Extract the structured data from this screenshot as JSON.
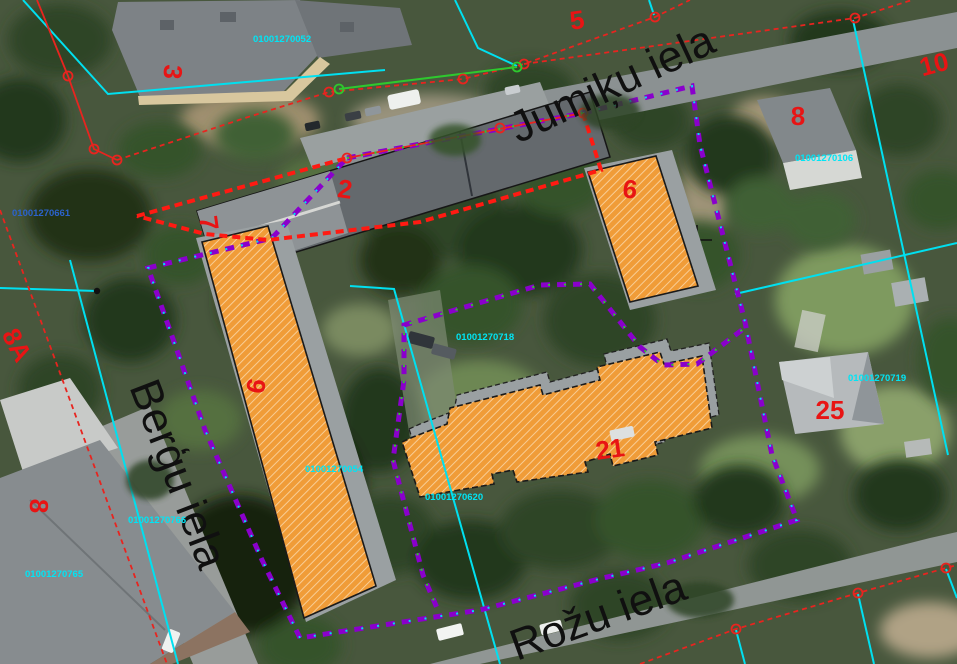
{
  "map": {
    "streets": {
      "jumiku": "Jumiķu iela",
      "bergu": "Berģu iela",
      "rozu": "Rožu iela"
    },
    "parcel_numbers": {
      "p3": "3",
      "p5": "5",
      "p10": "10",
      "p8_ne": "8",
      "p2": "2",
      "p7": "7",
      "p6": "6",
      "p8a": "8A",
      "p9": "9",
      "p8_w": "8",
      "p25": "25",
      "p21": "21"
    },
    "cadastral_codes": {
      "c052": "01001270052",
      "c106": "01001270106",
      "c661": "01001270661",
      "c718": "01001270718",
      "c719": "01001270719",
      "c054": "01001270054",
      "c766": "01001270766",
      "c765": "01001270765",
      "c620": "01001270620"
    },
    "highlighted_buildings": [
      "9",
      "6",
      "21"
    ],
    "colors": {
      "parcel_number": "#e81414",
      "cadastral_code": "#00e5f5",
      "cadastral_code_alt": "#2b63cc",
      "street_name": "#101010",
      "boundary_red": "#ff1a12",
      "boundary_purple": "#8a00cc",
      "boundary_cyan": "#00e0f0",
      "survey_green": "#2ec82e",
      "building_highlight": "#f09c38"
    }
  }
}
